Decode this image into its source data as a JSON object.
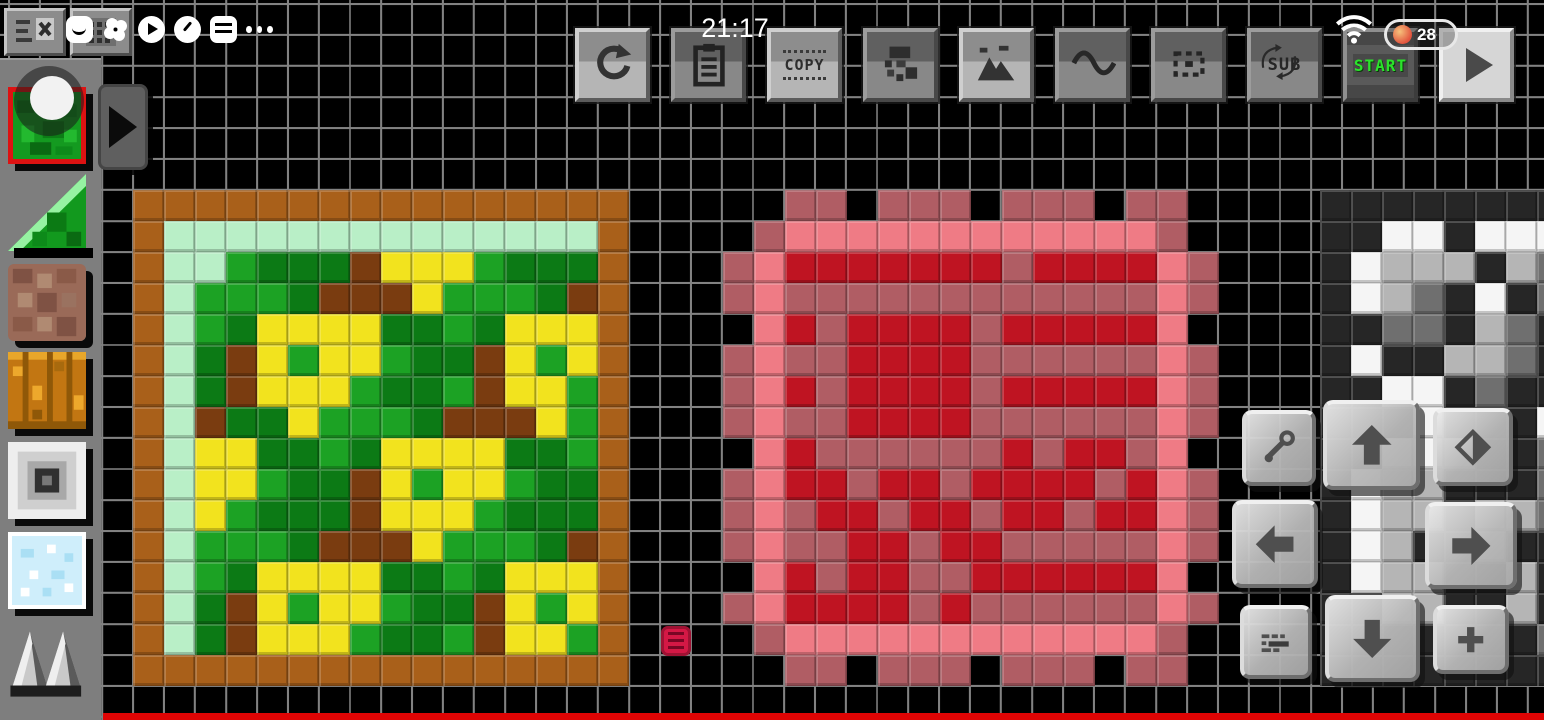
{
  "status_bar": {
    "time": "21:17",
    "battery_percent": "28",
    "wifi_icon": "wifi-icon",
    "battery_colors": {
      "outline": "#e8e8e8",
      "low_dot": "#e2543e",
      "text": "#ffffff"
    }
  },
  "system_overlay": {
    "icons": [
      "smile-icon",
      "pinwheel-icon",
      "play-circle-icon",
      "gauge-icon",
      "card-stack-icon",
      "ellipsis-icon"
    ]
  },
  "topleft_buttons": [
    {
      "name": "list-clear-button",
      "icon": "list-x-icon"
    },
    {
      "name": "keypad-button",
      "icon": "keypad-icon"
    }
  ],
  "toolbar": {
    "buttons": [
      {
        "name": "undo-button",
        "icon": "undo-icon",
        "variant": "light"
      },
      {
        "name": "clipboard-button",
        "icon": "clipboard-icon",
        "variant": "dark"
      },
      {
        "name": "copy-button",
        "label": "COPY",
        "variant": "light"
      },
      {
        "name": "sprite-button",
        "icon": "pixel-sprite-icon",
        "variant": "dark"
      },
      {
        "name": "image-button",
        "icon": "landscape-icon",
        "variant": "light"
      },
      {
        "name": "wave-button",
        "icon": "wave-icon",
        "variant": "dark"
      },
      {
        "name": "selection-button",
        "icon": "dashed-selection-icon",
        "variant": "dark"
      },
      {
        "name": "sub-button",
        "label": "SUB",
        "icon": "rotate-arrows-icon",
        "variant": "dark"
      },
      {
        "name": "start-button",
        "label": "START",
        "variant": "start",
        "label_color": "#2be32b"
      },
      {
        "name": "play-button",
        "icon": "play-icon",
        "variant": "flat"
      }
    ]
  },
  "sidebar": {
    "selected_index": 0,
    "selection_color": "#dd1212",
    "tools": [
      {
        "name": "grass-leaves-block",
        "selected": true
      },
      {
        "name": "grass-ramp-block"
      },
      {
        "name": "dirt-block"
      },
      {
        "name": "planks-block"
      },
      {
        "name": "frame-block"
      },
      {
        "name": "ice-block"
      },
      {
        "name": "spikes-block"
      }
    ],
    "expander_icon": "right-triangle-icon"
  },
  "canvas": {
    "cell_size": 31,
    "palette": {
      "O": "#a9601a",
      "M": "#b9efc7",
      "G": "#1ca224",
      "D": "#0c7a15",
      "B": "#7a3c10",
      "Y": "#f2e31e",
      "P": "#ef7b85",
      "U": "#b05d64",
      "R": "#bf1422",
      "C": "#262626",
      "W": "#f5f5f5",
      "L": "#b5b5b5",
      "N": "#6f6f6f",
      ".": null
    },
    "artworks": [
      {
        "name": "grass-flower-tile",
        "x": 133,
        "y": 190,
        "rows": [
          "OOOOOOOOOOOOOOOO",
          "OMMMMMMMMMMMMMMO",
          "OMMGDDDBYYYGDDDO",
          "OMGGGDBBBYGGGDBO",
          "OMGDYYYYDDGDYYYO",
          "OMDBYGYYGDDBYGYO",
          "OMDBYYYGDDGBYYGO",
          "OMBDDYGGGDBBBYGO",
          "OMYYDDGDYYYYDDGO",
          "OMYYGDDBYGYYGDDO",
          "OMYGDDDBYYYGDDDO",
          "OMGGGDBBBYGGGDBO",
          "OMGDYYYYDDGDYYYO",
          "OMDBYGYYGDDBYGYO",
          "OMDBYYYGDDGBYYGO",
          "OOOOOOOOOOOOOOOO"
        ]
      },
      {
        "name": "red-ornament-tile",
        "x": 723,
        "y": 190,
        "rows": [
          "..UU.UUU.UUU.UU.",
          ".UPPPPPPPPPPPPU.",
          "UPRRRRRRRURRRRPU",
          "UPUUUUUUUUUUUUPU",
          ".PRURRRRURRRRRP.",
          "UPUURRRRUUUUUUPU",
          "UPRURRRRURRRRRPU",
          "UPUURRRRUUUUUUPU",
          ".PRUUUUUURURRUP.",
          "UPRRURRURRRRURPU",
          "UPURRURRURRURRPU",
          "UPUURRURRUUUUUPU",
          ".PRURRUURRRRRRP.",
          "UPRRRRURUUUUUUPU",
          ".UPPPPPPPPPPPPU.",
          "..UU.UUU.UUU.UU."
        ]
      },
      {
        "name": "mono-pattern-tile",
        "x": 1320,
        "y": 190,
        "rows": [
          "CCCCCCCC",
          "CCWWCWWW",
          "CWLLLCLN",
          "CWLNCWCN",
          "CCNNCLNC",
          "CWCCLLNC",
          "CCWWCNCC",
          "CCCWCCCW",
          "CCWWLCCN",
          "CWLLCCCN",
          "CWLLCLLN",
          "CWLCCLCC",
          "CWLLCCLC",
          "CCLLCCLC",
          "CCCCCCCN",
          "CCCCCCCC"
        ]
      }
    ],
    "loose_sprite": {
      "name": "small-red-sprite",
      "x": 661,
      "y": 626,
      "color": "#d41845",
      "stripe_color": "#8f0c2e"
    }
  },
  "dpad": {
    "buttons": [
      {
        "name": "wrench-button",
        "icon": "wrench-icon"
      },
      {
        "name": "up-button",
        "icon": "arrow-up-icon"
      },
      {
        "name": "fill-button",
        "icon": "paint-diamond-icon"
      },
      {
        "name": "left-button",
        "icon": "arrow-left-icon"
      },
      {
        "name": "right-button",
        "icon": "arrow-right-icon"
      },
      {
        "name": "detail-button",
        "icon": "mini-rows-icon"
      },
      {
        "name": "down-button",
        "icon": "arrow-down-icon"
      },
      {
        "name": "plus-button",
        "icon": "plus-icon"
      }
    ]
  },
  "footer": {
    "strip_color": "#e00404"
  }
}
